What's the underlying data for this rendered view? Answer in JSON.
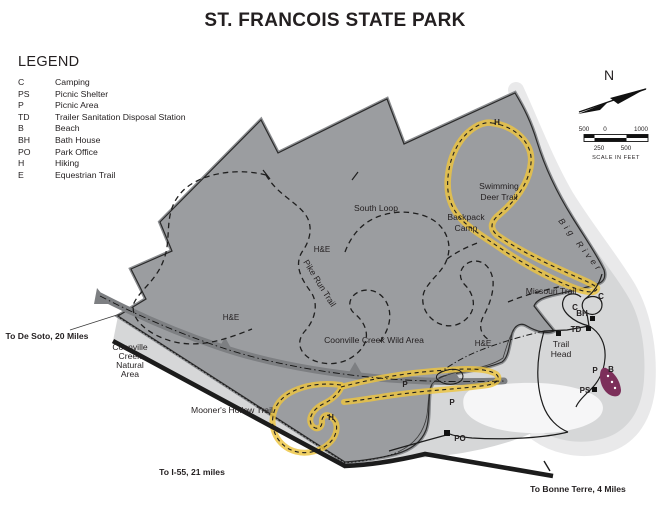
{
  "title": "ST. FRANCOIS STATE PARK",
  "legend": {
    "heading": "LEGEND",
    "items": [
      {
        "abbr": "C",
        "label": "Camping"
      },
      {
        "abbr": "PS",
        "label": "Picnic Shelter"
      },
      {
        "abbr": "P",
        "label": "Picnic Area"
      },
      {
        "abbr": "TD",
        "label": "Trailer Sanitation Disposal Station"
      },
      {
        "abbr": "B",
        "label": "Beach"
      },
      {
        "abbr": "BH",
        "label": "Bath House"
      },
      {
        "abbr": "PO",
        "label": "Park Office"
      },
      {
        "abbr": "H",
        "label": "Hiking"
      },
      {
        "abbr": "E",
        "label": "Equestrian Trail"
      }
    ]
  },
  "compass": {
    "north_label": "N"
  },
  "scale_bar": {
    "top_labels": [
      "500",
      "0",
      "1000"
    ],
    "bottom_labels": [
      "250",
      "500"
    ],
    "caption": "SCALE IN FEET"
  },
  "map": {
    "area_labels": {
      "south_loop": "South Loop",
      "backpack_camp": [
        "Backpack",
        "Camp"
      ],
      "swimming_deer": [
        "Swimming",
        "Deer Trail"
      ],
      "big_river": "Big River",
      "missouri_trail": "Missouri Trail",
      "trail_head": [
        "Trail",
        "Head"
      ],
      "coonville_wild": "Coonville Creek Wild Area",
      "coonville_natural": [
        "Coonville",
        "Creek",
        "Natural",
        "Area"
      ],
      "mooners_hollow": "Mooner's Hollow Trail",
      "pike_run": "Pike Run Trail"
    },
    "road_labels": {
      "to_de_soto": "To De Soto, 20 Miles",
      "to_i55": "To I-55, 21 miles",
      "to_bonne_terre": "To Bonne Terre, 4 Miles"
    },
    "he_labels": [
      "H&E",
      "H&E",
      "H&E"
    ],
    "markers": {
      "camp1": "C",
      "camp2": "C",
      "bath_house": "BH",
      "trailer_disposal": "TD",
      "picnic_near_beach": "P",
      "beach": "B",
      "picnic_shelter": "PS",
      "picnic1": "P",
      "picnic2": "P",
      "park_office": "PO",
      "hiking_swimming_deer": "H",
      "hiking_mooners": "H"
    }
  },
  "colors": {
    "park_area": "#9b9da0",
    "creek": "#7d7f82",
    "open_area_light": "#d6d7d8",
    "open_area_halo": "#e9e9ea",
    "white_area": "#f6f6f7",
    "trail_highlight": "#edc53f",
    "beach_marker": "#7c2f5a",
    "road": "#1c1c1c",
    "text": "#231f20"
  }
}
